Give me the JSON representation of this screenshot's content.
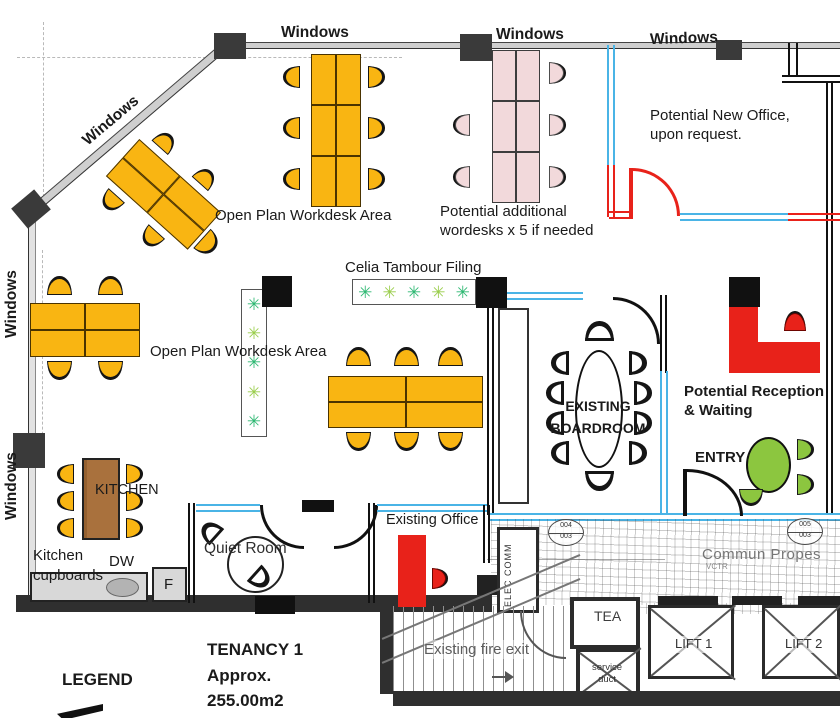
{
  "areas": {
    "windows": {
      "diag": "Windows",
      "top1": "Windows",
      "top2": "Windows",
      "top3": "Windows",
      "left1": "Windows",
      "left2": "Windows"
    },
    "open_plan_1": "Open Plan Workdesk Area",
    "open_plan_2": "Open Plan Workdesk Area",
    "potential_additional_line1": "Potential additional",
    "potential_additional_line2": "wordesks x 5 if needed",
    "potential_new_office_line1": "Potential New Office,",
    "potential_new_office_line2": "upon request.",
    "celia_filing": "Celia Tambour Filing",
    "boardroom_line1": "EXISTING",
    "boardroom_line2": "BOARDROOM",
    "reception_line1": "Potential Reception",
    "reception_line2": "& Waiting",
    "entry": "ENTRY",
    "kitchen": "KITCHEN",
    "kitchen_cupboards_line1": "Kitchen",
    "kitchen_cupboards_line2": "cupboards",
    "dishwasher": "DW",
    "fridge": "F",
    "quiet_room": "Quiet Room",
    "existing_office": "Existing Office",
    "elec_comm": "ELEC COMM",
    "common_property": "Commun Propes",
    "common_property_sub": "VCTR",
    "tea": "TEA",
    "service_duct_line1": "service",
    "service_duct_line2": "duct",
    "lift_1": "LIFT 1",
    "lift_2": "LIFT 2",
    "fire_exit": "Existing fire exit"
  },
  "summary": {
    "tenancy_line1": "TENANCY 1",
    "tenancy_line2": "Approx.",
    "tenancy_line3": "255.00m2",
    "legend": "LEGEND"
  },
  "door_tags": {
    "tag1_top": "004",
    "tag1_bottom": "003",
    "tag2_top": "005",
    "tag2_bottom": "003"
  },
  "colors": {
    "desk_yellow": "#F9B512",
    "desk_pink": "#F2D9DB",
    "new_works_red": "#E8221A",
    "partition_blue": "#4AB4E6",
    "waiting_green": "#8CC63F",
    "kitchen_wood": "#A9713D"
  }
}
